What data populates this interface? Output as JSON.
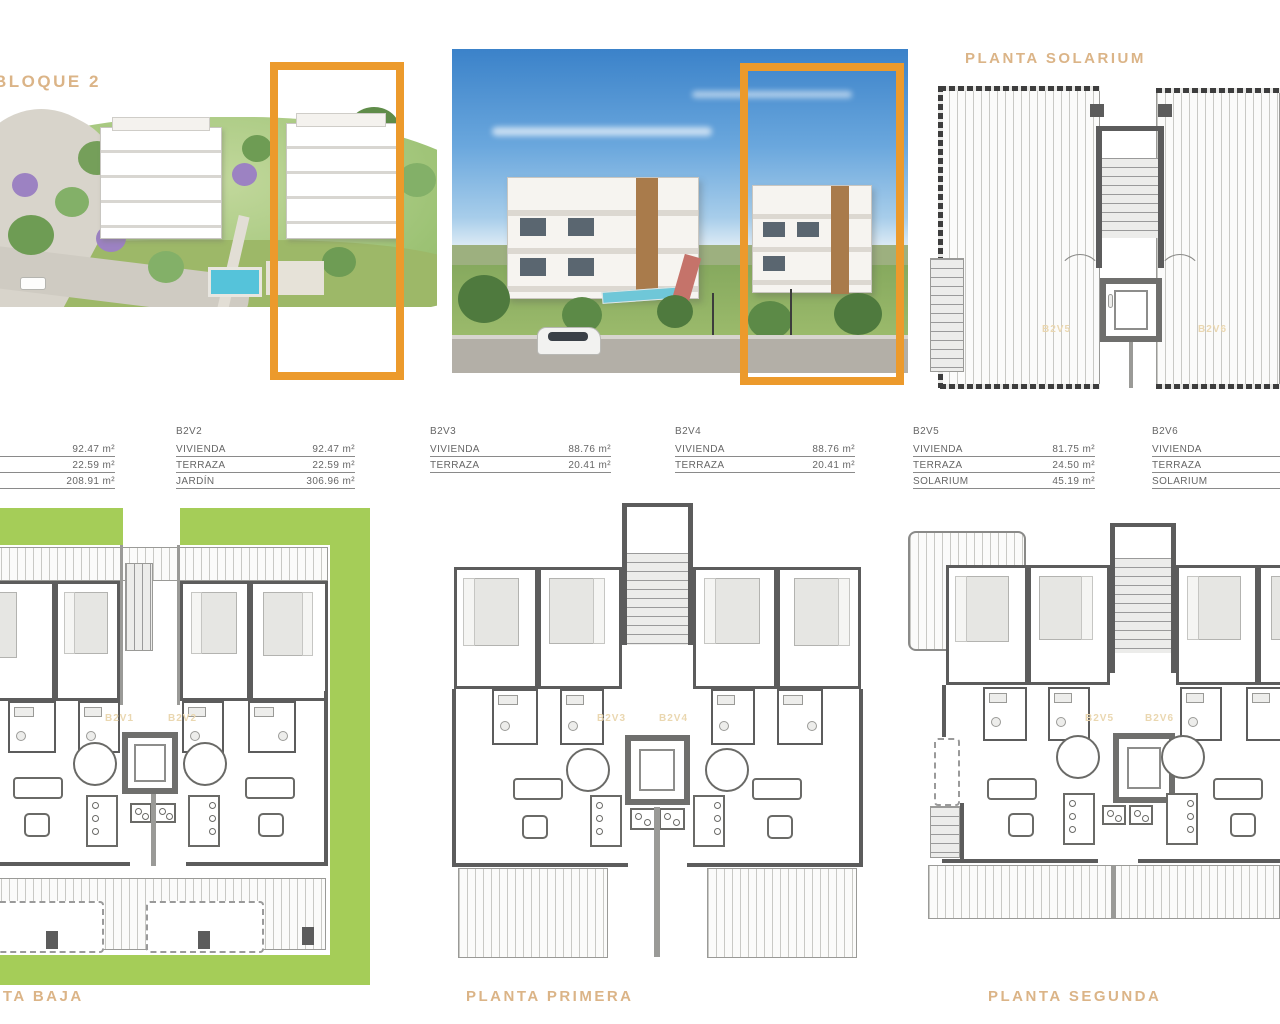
{
  "headings": {
    "block": "BLOQUE 2",
    "solarium": "PLANTA SOLARIUM",
    "ground": "PLANTA BAJA",
    "first": "PLANTA PRIMERA",
    "second": "PLANTA SEGUNDA"
  },
  "unit_tables": [
    {
      "name": "",
      "rows": [
        {
          "label": "",
          "value": "92.47 m²"
        },
        {
          "label": "",
          "value": "22.59 m²"
        },
        {
          "label": "",
          "value": "208.91 m²"
        }
      ]
    },
    {
      "name": "B2V2",
      "rows": [
        {
          "label": "VIVIENDA",
          "value": "92.47 m²"
        },
        {
          "label": "TERRAZA",
          "value": "22.59 m²"
        },
        {
          "label": "JARDÍN",
          "value": "306.96 m²"
        }
      ]
    },
    {
      "name": "B2V3",
      "rows": [
        {
          "label": "VIVIENDA",
          "value": "88.76 m²"
        },
        {
          "label": "TERRAZA",
          "value": "20.41 m²"
        }
      ]
    },
    {
      "name": "B2V4",
      "rows": [
        {
          "label": "VIVIENDA",
          "value": "88.76 m²"
        },
        {
          "label": "TERRAZA",
          "value": "20.41 m²"
        }
      ]
    },
    {
      "name": "B2V5",
      "rows": [
        {
          "label": "VIVIENDA",
          "value": "81.75 m²"
        },
        {
          "label": "TERRAZA",
          "value": "24.50 m²"
        },
        {
          "label": "SOLARIUM",
          "value": "45.19 m²"
        }
      ]
    },
    {
      "name": "B2V6",
      "rows": [
        {
          "label": "VIVIENDA",
          "value": ""
        },
        {
          "label": "TERRAZA",
          "value": ""
        },
        {
          "label": "SOLARIUM",
          "value": ""
        }
      ]
    }
  ],
  "plan_labels": {
    "solarium": [
      "B2V5",
      "B2V6"
    ],
    "ground": [
      "B2V1",
      "B2V2"
    ],
    "first": [
      "B2V3",
      "B2V4"
    ],
    "second": [
      "B2V5",
      "B2V6"
    ]
  },
  "colors": {
    "accent_orange": "#EC9A2C",
    "heading_tan": "#DBB487",
    "faint_unit_label": "#EAD7B0",
    "garden_green": "#A5CD58",
    "wall_gray": "#5C5C5C",
    "sky_blue": "#3B82C9"
  }
}
